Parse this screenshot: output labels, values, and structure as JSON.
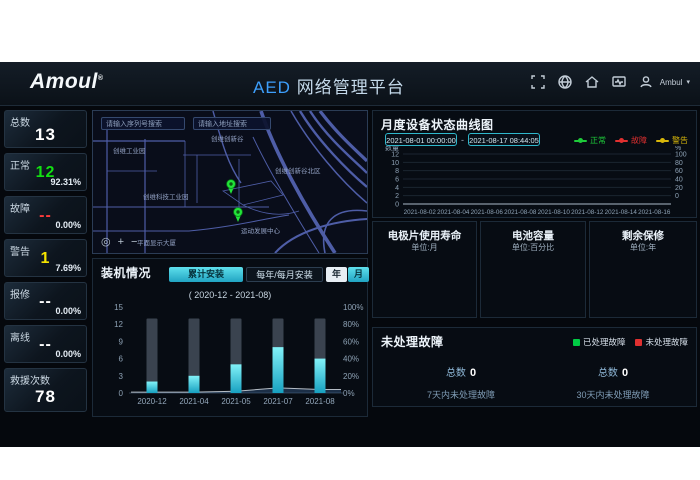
{
  "brand": {
    "name": "Amoul",
    "reg": "®"
  },
  "header": {
    "title_primary": "AED",
    "title_secondary": "网络管理平台",
    "user_name": "Ambul",
    "caret": "▾"
  },
  "sidebar": {
    "stats": [
      {
        "label": "总数",
        "value": "13",
        "percent": "",
        "color": "#ffffff"
      },
      {
        "label": "正常",
        "value": "12",
        "percent": "92.31%",
        "color": "#12e012"
      },
      {
        "label": "故障",
        "value": "--",
        "percent": "0.00%",
        "color": "#ff3b3b"
      },
      {
        "label": "警告",
        "value": "1",
        "percent": "7.69%",
        "color": "#f5e400"
      },
      {
        "label": "报修",
        "value": "--",
        "percent": "0.00%",
        "color": "#ffffff"
      },
      {
        "label": "离线",
        "value": "--",
        "percent": "0.00%",
        "color": "#ffffff"
      },
      {
        "label": "救援次数",
        "value": "78",
        "percent": "",
        "color": "#ffffff"
      }
    ]
  },
  "map": {
    "search_serial_placeholder": "请输入序列号搜索",
    "search_address_placeholder": "请输入地址搜索",
    "labels": [
      "创维工业园",
      "创维创新谷",
      "创维科技工业园",
      "创维创新谷北区",
      "平面显示大厦",
      "运动发展中心"
    ],
    "controls": {
      "locate": "◎",
      "zoom_in": "+",
      "zoom_out": "−"
    }
  },
  "install_panel": {
    "title": "装机情况",
    "tab_cumulative": "累计安装",
    "tab_periodic": "每年/每月安装",
    "btn_year": "年",
    "btn_month": "月",
    "subtitle": "( 2020-12 - 2021-08)",
    "chart_data": {
      "type": "bar",
      "categories": [
        "2020-12",
        "2021-04",
        "2021-05",
        "2021-07",
        "2021-08"
      ],
      "values": [
        2,
        3,
        5,
        8,
        6
      ],
      "total_value": 13,
      "percent_line": [
        1,
        1,
        2,
        6,
        4
      ],
      "y_left_ticks": [
        "15",
        "12",
        "9",
        "6",
        "3",
        "0"
      ],
      "y_right_ticks": [
        "100%",
        "80%",
        "60%",
        "40%",
        "20%",
        "0%"
      ]
    }
  },
  "status_panel": {
    "title": "月度设备状态曲线图",
    "date_from": "2021-08-01 00:00:00",
    "date_sep": "-",
    "date_to": "2021-08-17 08:44:05",
    "legend": [
      {
        "label": "正常",
        "color": "#1ecb3a"
      },
      {
        "label": "故障",
        "color": "#e03030"
      },
      {
        "label": "警告",
        "color": "#d8b70a"
      }
    ],
    "chart_data": {
      "type": "line",
      "y_label_left": "数量",
      "y_label_right": "%",
      "y_ticks_left": [
        "12",
        "10",
        "8",
        "6",
        "4",
        "2",
        "0"
      ],
      "y_ticks_right": [
        "100",
        "80",
        "60",
        "40",
        "20",
        "0"
      ],
      "x_ticks": [
        "2021-08-02",
        "2021-08-04",
        "2021-08-06",
        "2021-08-08",
        "2021-08-10",
        "2021-08-12",
        "2021-08-14",
        "2021-08-16"
      ],
      "series": [
        {
          "name": "正常",
          "values": [
            11,
            9.6,
            9,
            9.7,
            10.4,
            10.4,
            10.4,
            10.5,
            11.8,
            12,
            12,
            12,
            12,
            12,
            12,
            12,
            12
          ]
        },
        {
          "name": "故障",
          "values": [
            0,
            0.7,
            0.4,
            0.1,
            0,
            0,
            0,
            0,
            0,
            0,
            0,
            0,
            0,
            0,
            0,
            0,
            0
          ]
        },
        {
          "name": "警告",
          "values": [
            1,
            1,
            1,
            1,
            1,
            1,
            1,
            1,
            1,
            1,
            1,
            1,
            1,
            1,
            1,
            1,
            1
          ]
        }
      ]
    }
  },
  "gauges": [
    {
      "title": "电极片使用寿命",
      "unit": "单位:月",
      "values": [
        6,
        0,
        1,
        2
      ],
      "labels": [
        "≤12",
        "≤3",
        "≤1",
        "失效"
      ]
    },
    {
      "title": "电池容量",
      "unit": "单位:百分比",
      "values": [
        0,
        0,
        0
      ],
      "labels": [
        "45%",
        "20%",
        "低电量"
      ]
    },
    {
      "title": "剩余保修",
      "unit": "单位:年",
      "values": [
        5,
        7,
        1
      ],
      "labels": [
        ">1",
        "≤1",
        "过保"
      ]
    }
  ],
  "faults_panel": {
    "title": "未处理故障",
    "legend": [
      {
        "label": "已处理故障",
        "color": "#00cc44"
      },
      {
        "label": "未处理故障",
        "color": "#e03030"
      }
    ],
    "groups": [
      {
        "total_label": "总数",
        "total_value": "0",
        "sub_label": "7天内未处理故障"
      },
      {
        "total_label": "总数",
        "total_value": "0",
        "sub_label": "30天内未处理故障"
      }
    ]
  },
  "colors": {
    "accent_cyan": "#4fd6e4",
    "bar_bg": "#3a434f",
    "panel_border": "#1c2a38"
  }
}
